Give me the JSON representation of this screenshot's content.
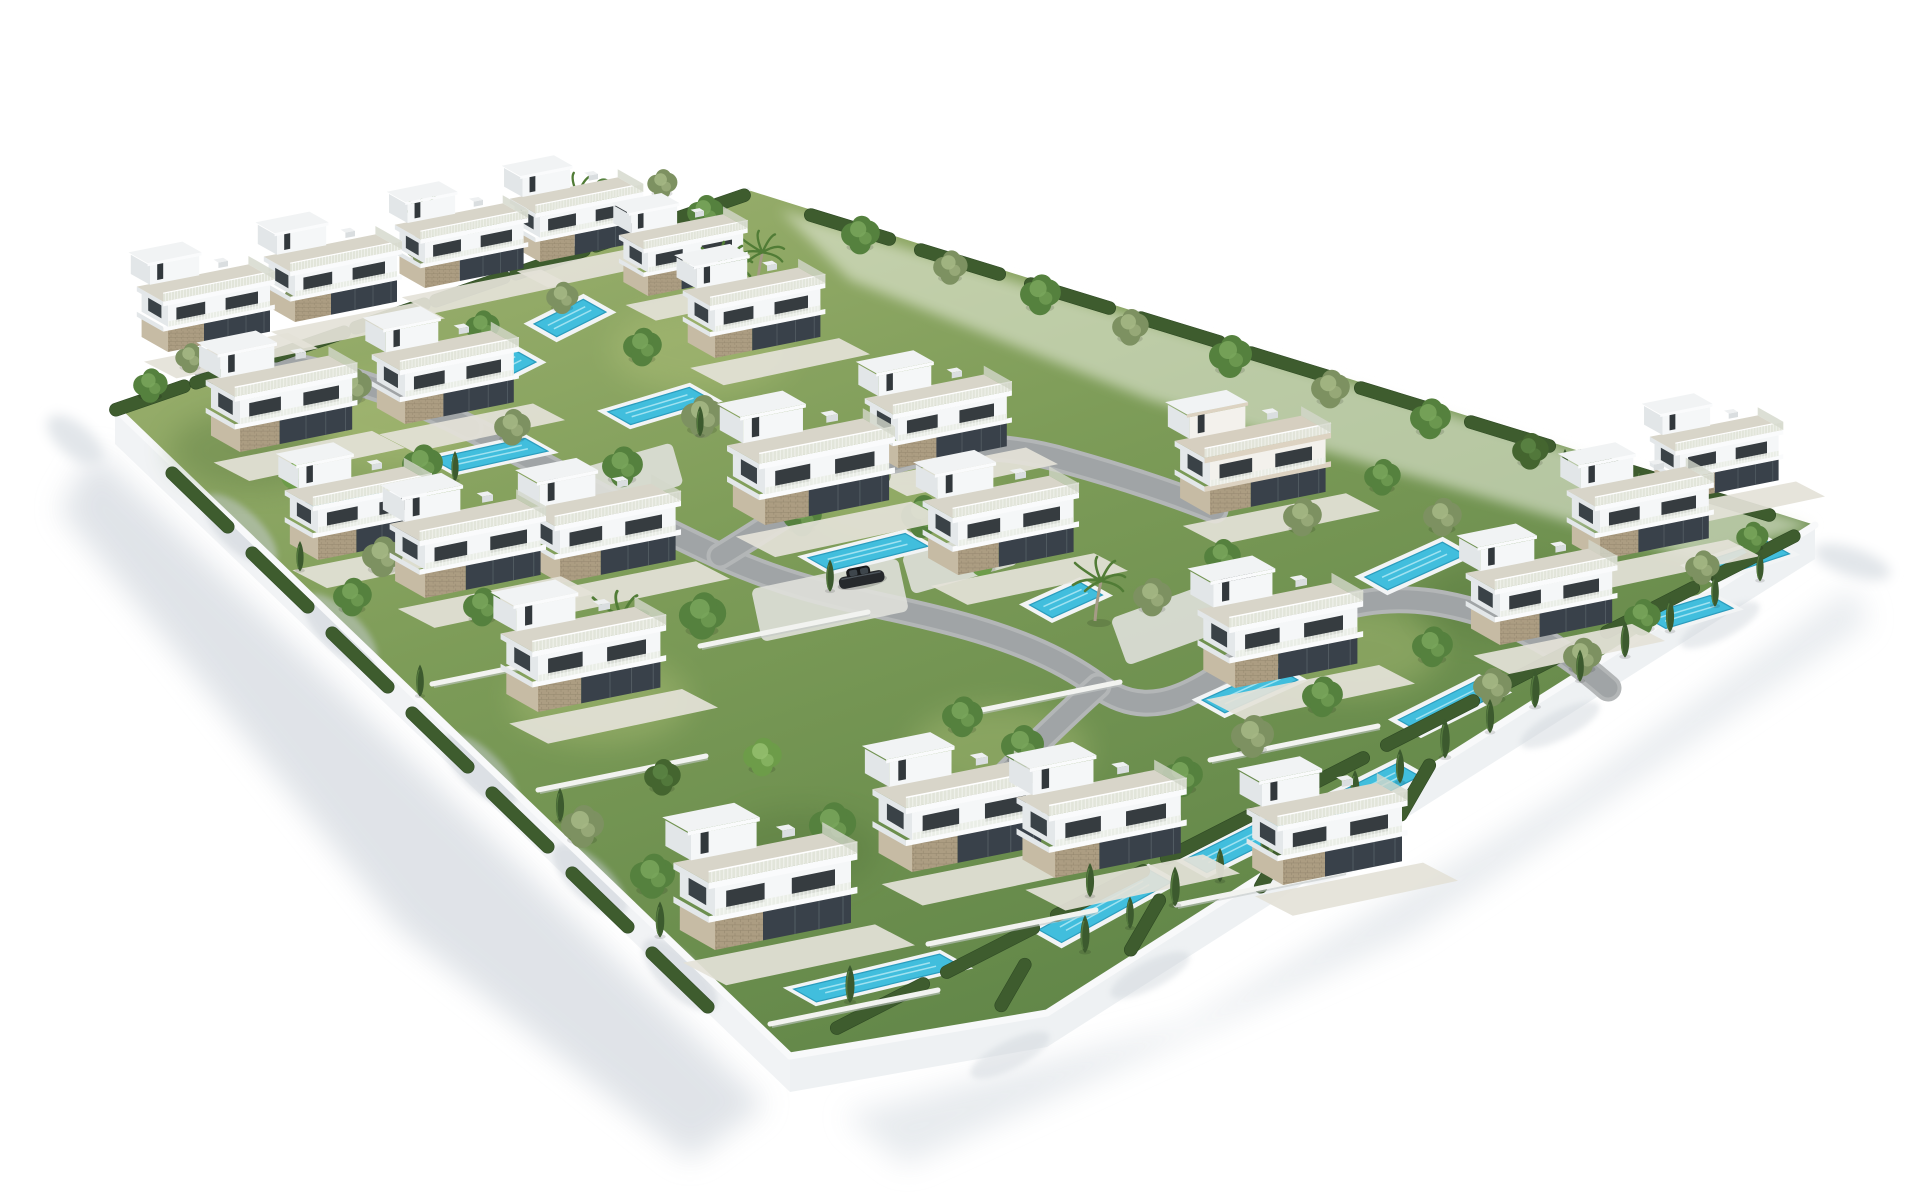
{
  "scene": {
    "subject": "aerial 3d render of a gated residential development of white modern villas with rooftop terraces, private turquoise pools, gardens, trees and winding gray roads inside a white perimeter wall on a plain white background",
    "background_color": "#ffffff",
    "palette": {
      "villa_white": "#f5f7f8",
      "villa_shade": "#e4e8ea",
      "slab_white": "#fafbfc",
      "glass_dark": "#39414a",
      "stone_tan": "#ac9d82",
      "deck_gray": "#d8d5c9",
      "grass_light": "#a3b573",
      "grass_mid": "#7d9c58",
      "grass_dark": "#5c8245",
      "hedge_green": "#3e5c2e",
      "tree_green": "#55813e",
      "pool_cyan": "#41bedd",
      "pool_deep": "#2b9cbd",
      "road_gray": "#9fa3a4",
      "wall_white": "#f1f3f5",
      "shadow_gray": "#dde1e6",
      "car_dark": "#26292c"
    },
    "counts": {
      "villas": 24,
      "swimming_pools": 16,
      "cars": 2,
      "palm_trees": 6,
      "round_trees": 64,
      "cypress_trees": 32
    },
    "walls": {
      "plot": "115,408 748,190 1815,525 1420,775 1047,1013 790,1056",
      "left_face": "115,408 790,1056 790,1092 115,444",
      "bottom_face": "790,1056 1047,1013 1420,775 1815,525 1815,559 1420,809 1047,1047 790,1092",
      "cap_left": "115,408 790,1056",
      "cap_bottom": "790,1056 1047,1013 1420,775 1815,525",
      "cap_top": "115,408 748,190",
      "pale_topright": "780,210 1815,525 1700,560 1150,400 850,280"
    },
    "ground_shadows": {
      "left": "95,450 765,1105 690,1160 400,930 215,700 60,510",
      "bottom_right": "845,1115 1185,1025 1565,795 1852,588 1868,622 1410,935 905,1165",
      "blobs": [
        {
          "x": 75,
          "y": 440,
          "rx": 34,
          "ry": 16,
          "a": 40
        },
        {
          "x": 1852,
          "y": 562,
          "rx": 40,
          "ry": 14,
          "a": 18
        }
      ],
      "wall_blobs_left": [
        [
          240,
          530
        ],
        [
          340,
          630
        ],
        [
          480,
          770
        ],
        [
          590,
          880
        ],
        [
          680,
          975
        ]
      ],
      "wall_blobs_bottom": [
        [
          1010,
          1055
        ],
        [
          1150,
          975
        ],
        [
          1340,
          860
        ],
        [
          1560,
          725
        ],
        [
          1720,
          625
        ]
      ]
    },
    "grass_patches": {
      "light": [
        [
          400,
          420
        ],
        [
          700,
          350
        ],
        [
          600,
          700
        ],
        [
          1000,
          750
        ],
        [
          1350,
          650
        ],
        [
          900,
          500
        ]
      ],
      "dark": [
        [
          250,
          450
        ],
        [
          800,
          850
        ],
        [
          1500,
          600
        ]
      ]
    },
    "roads": [
      "M 470,428 C 560,472 640,520 720,556 S 860,600 930,617 C 1010,636 1060,658 1098,686 C 1140,716 1180,706 1238,662 C 1300,615 1360,592 1432,602 C 1505,613 1560,646 1608,688",
      "M 720,556 C 780,520 830,482 890,462 C 950,442 1010,444 1070,462 C 1120,476 1170,492 1215,510",
      "M 470,428 C 420,402 370,384 320,372 C 280,362 240,360 205,366",
      "M 1098,686 C 1060,720 1020,760 980,800"
    ],
    "pads": [
      {
        "x": 830,
        "y": 600,
        "w": 150,
        "h": 54,
        "a": -12
      },
      {
        "x": 1180,
        "y": 620,
        "w": 130,
        "h": 50,
        "a": -20
      },
      {
        "x": 620,
        "y": 480,
        "w": 120,
        "h": 44,
        "a": -16
      },
      {
        "x": 960,
        "y": 560,
        "w": 110,
        "h": 40,
        "a": -16
      }
    ],
    "pools": [
      {
        "x": 346,
        "y": 500,
        "l": 60,
        "k": -0.3
      },
      {
        "x": 490,
        "y": 455,
        "l": 95,
        "k": -0.22
      },
      {
        "x": 500,
        "y": 368,
        "l": 55,
        "k": -0.5
      },
      {
        "x": 570,
        "y": 318,
        "l": 55,
        "k": -0.5
      },
      {
        "x": 660,
        "y": 406,
        "l": 85,
        "k": -0.3
      },
      {
        "x": 868,
        "y": 552,
        "l": 100,
        "k": -0.25
      },
      {
        "x": 1066,
        "y": 600,
        "l": 55,
        "k": -0.45
      },
      {
        "x": 1415,
        "y": 566,
        "l": 85,
        "k": -0.45
      },
      {
        "x": 1740,
        "y": 560,
        "l": 80,
        "k": -0.33
      },
      {
        "x": 1250,
        "y": 690,
        "l": 80,
        "k": -0.45
      },
      {
        "x": 1450,
        "y": 706,
        "l": 90,
        "k": -0.5
      },
      {
        "x": 1688,
        "y": 612,
        "l": 70,
        "k": -0.3
      },
      {
        "x": 878,
        "y": 978,
        "l": 150,
        "k": -0.24
      },
      {
        "x": 1105,
        "y": 906,
        "l": 125,
        "k": -0.55
      },
      {
        "x": 1238,
        "y": 845,
        "l": 95,
        "k": -0.5
      },
      {
        "x": 1368,
        "y": 790,
        "l": 90,
        "k": -0.5
      }
    ],
    "hedges": [
      {
        "x": 150,
        "y": 398,
        "l": 85,
        "a": -19
      },
      {
        "x": 230,
        "y": 371,
        "l": 85,
        "a": -19
      },
      {
        "x": 310,
        "y": 344,
        "l": 85,
        "a": -19
      },
      {
        "x": 390,
        "y": 316,
        "l": 85,
        "a": -19
      },
      {
        "x": 470,
        "y": 289,
        "l": 85,
        "a": -19
      },
      {
        "x": 550,
        "y": 262,
        "l": 85,
        "a": -19
      },
      {
        "x": 630,
        "y": 234,
        "l": 85,
        "a": -19
      },
      {
        "x": 710,
        "y": 207,
        "l": 85,
        "a": -19
      },
      {
        "x": 880,
        "y": 1006,
        "l": 110,
        "a": -27
      },
      {
        "x": 990,
        "y": 950,
        "l": 110,
        "a": -27
      },
      {
        "x": 1100,
        "y": 893,
        "l": 110,
        "a": -27
      },
      {
        "x": 1210,
        "y": 836,
        "l": 110,
        "a": -27
      },
      {
        "x": 1320,
        "y": 780,
        "l": 110,
        "a": -27
      },
      {
        "x": 1430,
        "y": 723,
        "l": 110,
        "a": -27
      },
      {
        "x": 1540,
        "y": 666,
        "l": 110,
        "a": -27
      },
      {
        "x": 1650,
        "y": 610,
        "l": 110,
        "a": -27
      },
      {
        "x": 1755,
        "y": 556,
        "l": 100,
        "a": -27
      },
      {
        "x": 200,
        "y": 500,
        "l": 90,
        "a": 44
      },
      {
        "x": 280,
        "y": 580,
        "l": 90,
        "a": 44
      },
      {
        "x": 360,
        "y": 660,
        "l": 90,
        "a": 44
      },
      {
        "x": 440,
        "y": 740,
        "l": 90,
        "a": 44
      },
      {
        "x": 520,
        "y": 820,
        "l": 90,
        "a": 44
      },
      {
        "x": 600,
        "y": 900,
        "l": 90,
        "a": 44
      },
      {
        "x": 680,
        "y": 980,
        "l": 90,
        "a": 44
      },
      {
        "x": 850,
        "y": 227,
        "l": 95,
        "a": 17
      },
      {
        "x": 960,
        "y": 262,
        "l": 95,
        "a": 17
      },
      {
        "x": 1070,
        "y": 296,
        "l": 95,
        "a": 17
      },
      {
        "x": 1180,
        "y": 330,
        "l": 95,
        "a": 17
      },
      {
        "x": 1290,
        "y": 365,
        "l": 95,
        "a": 17
      },
      {
        "x": 1400,
        "y": 400,
        "l": 95,
        "a": 17
      },
      {
        "x": 1510,
        "y": 434,
        "l": 95,
        "a": 17
      },
      {
        "x": 1620,
        "y": 468,
        "l": 95,
        "a": 17
      },
      {
        "x": 1730,
        "y": 503,
        "l": 95,
        "a": 17
      },
      {
        "x": 1145,
        "y": 925,
        "l": 70,
        "a": -60
      },
      {
        "x": 1275,
        "y": 862,
        "l": 70,
        "a": -60
      },
      {
        "x": 1013,
        "y": 985,
        "l": 60,
        "a": -60
      },
      {
        "x": 1415,
        "y": 790,
        "l": 70,
        "a": -60
      }
    ],
    "low_walls": [
      [
        700,
        646,
        868,
        612
      ],
      [
        432,
        684,
        600,
        650
      ],
      [
        952,
        716,
        1120,
        682
      ],
      [
        1210,
        760,
        1378,
        726
      ],
      [
        538,
        790,
        706,
        756
      ],
      [
        770,
        1024,
        938,
        990
      ],
      [
        928,
        944,
        1096,
        910
      ],
      [
        1176,
        905,
        1344,
        871
      ]
    ],
    "villas": [
      {
        "x": 168,
        "y": 352,
        "s": 0.6,
        "v": "a"
      },
      {
        "x": 295,
        "y": 322,
        "s": 0.6,
        "v": "a"
      },
      {
        "x": 425,
        "y": 288,
        "s": 0.58,
        "v": "a"
      },
      {
        "x": 540,
        "y": 262,
        "s": 0.58,
        "v": "a"
      },
      {
        "x": 648,
        "y": 296,
        "s": 0.56,
        "v": "a"
      },
      {
        "x": 715,
        "y": 358,
        "s": 0.62,
        "v": "a"
      },
      {
        "x": 240,
        "y": 452,
        "s": 0.66,
        "v": "a"
      },
      {
        "x": 405,
        "y": 424,
        "s": 0.64,
        "v": "a"
      },
      {
        "x": 898,
        "y": 468,
        "s": 0.64,
        "v": "a"
      },
      {
        "x": 958,
        "y": 575,
        "s": 0.68,
        "v": "a"
      },
      {
        "x": 765,
        "y": 525,
        "s": 0.73,
        "v": "a"
      },
      {
        "x": 425,
        "y": 598,
        "s": 0.68,
        "v": "a"
      },
      {
        "x": 560,
        "y": 583,
        "s": 0.68,
        "v": "a"
      },
      {
        "x": 538,
        "y": 712,
        "s": 0.72,
        "v": "a"
      },
      {
        "x": 1210,
        "y": 515,
        "s": 0.68,
        "v": "b"
      },
      {
        "x": 1235,
        "y": 688,
        "s": 0.72,
        "v": "a"
      },
      {
        "x": 1500,
        "y": 645,
        "s": 0.66,
        "v": "a"
      },
      {
        "x": 1600,
        "y": 560,
        "s": 0.64,
        "v": "a"
      },
      {
        "x": 1680,
        "y": 500,
        "s": 0.58,
        "v": "a"
      },
      {
        "x": 715,
        "y": 950,
        "s": 0.8,
        "v": "a"
      },
      {
        "x": 912,
        "y": 872,
        "s": 0.76,
        "v": "a"
      },
      {
        "x": 1055,
        "y": 878,
        "s": 0.74,
        "v": "a"
      },
      {
        "x": 1283,
        "y": 885,
        "s": 0.7,
        "v": "a"
      },
      {
        "x": 318,
        "y": 560,
        "s": 0.64,
        "v": "a"
      }
    ],
    "trees": [
      {
        "x": 150,
        "y": 390,
        "s": 0.8,
        "t": "g"
      },
      {
        "x": 190,
        "y": 362,
        "s": 0.7,
        "t": "o"
      },
      {
        "x": 235,
        "y": 332,
        "s": 0.9,
        "t": "g"
      },
      {
        "x": 300,
        "y": 302,
        "s": 0.75,
        "t": "o"
      },
      {
        "x": 362,
        "y": 282,
        "s": 0.9,
        "t": "d"
      },
      {
        "x": 422,
        "y": 252,
        "s": 0.8,
        "t": "o"
      },
      {
        "x": 482,
        "y": 232,
        "s": 0.85,
        "t": "g"
      },
      {
        "x": 542,
        "y": 212,
        "s": 0.7,
        "t": "o"
      },
      {
        "x": 602,
        "y": 200,
        "s": 0.8,
        "t": "g"
      },
      {
        "x": 662,
        "y": 188,
        "s": 0.7,
        "t": "o"
      },
      {
        "x": 705,
        "y": 218,
        "s": 0.85,
        "t": "g"
      },
      {
        "x": 860,
        "y": 240,
        "s": 0.9,
        "t": "g"
      },
      {
        "x": 950,
        "y": 272,
        "s": 0.8,
        "t": "o"
      },
      {
        "x": 1040,
        "y": 300,
        "s": 0.95,
        "t": "g"
      },
      {
        "x": 1130,
        "y": 332,
        "s": 0.85,
        "t": "o"
      },
      {
        "x": 1230,
        "y": 362,
        "s": 1.0,
        "t": "g"
      },
      {
        "x": 1330,
        "y": 394,
        "s": 0.9,
        "t": "o"
      },
      {
        "x": 1430,
        "y": 424,
        "s": 0.95,
        "t": "g"
      },
      {
        "x": 1530,
        "y": 456,
        "s": 0.85,
        "t": "d"
      },
      {
        "x": 1660,
        "y": 498,
        "s": 0.9,
        "t": "g"
      },
      {
        "x": 255,
        "y": 420,
        "s": 1.0,
        "t": "g"
      },
      {
        "x": 352,
        "y": 392,
        "s": 0.9,
        "t": "o"
      },
      {
        "x": 302,
        "y": 482,
        "s": 1.0,
        "t": "b"
      },
      {
        "x": 422,
        "y": 470,
        "s": 0.95,
        "t": "g"
      },
      {
        "x": 512,
        "y": 432,
        "s": 0.85,
        "t": "o"
      },
      {
        "x": 482,
        "y": 332,
        "s": 0.8,
        "t": "g"
      },
      {
        "x": 562,
        "y": 302,
        "s": 0.75,
        "t": "o"
      },
      {
        "x": 642,
        "y": 352,
        "s": 0.9,
        "t": "g"
      },
      {
        "x": 702,
        "y": 422,
        "s": 1.0,
        "t": "o"
      },
      {
        "x": 622,
        "y": 472,
        "s": 0.95,
        "t": "g"
      },
      {
        "x": 702,
        "y": 622,
        "s": 1.1,
        "t": "g"
      },
      {
        "x": 562,
        "y": 642,
        "s": 1.0,
        "t": "o"
      },
      {
        "x": 482,
        "y": 612,
        "s": 0.9,
        "t": "g"
      },
      {
        "x": 382,
        "y": 562,
        "s": 0.95,
        "t": "o"
      },
      {
        "x": 802,
        "y": 522,
        "s": 0.9,
        "t": "g"
      },
      {
        "x": 872,
        "y": 482,
        "s": 0.85,
        "t": "o"
      },
      {
        "x": 922,
        "y": 522,
        "s": 1.0,
        "t": "g"
      },
      {
        "x": 982,
        "y": 562,
        "s": 0.9,
        "t": "b"
      },
      {
        "x": 352,
        "y": 602,
        "s": 0.9,
        "t": "g"
      },
      {
        "x": 582,
        "y": 832,
        "s": 1.0,
        "t": "o"
      },
      {
        "x": 652,
        "y": 882,
        "s": 1.05,
        "t": "g"
      },
      {
        "x": 722,
        "y": 902,
        "s": 0.9,
        "t": "o"
      },
      {
        "x": 832,
        "y": 832,
        "s": 1.1,
        "t": "g"
      },
      {
        "x": 902,
        "y": 782,
        "s": 1.0,
        "t": "o"
      },
      {
        "x": 962,
        "y": 722,
        "s": 0.95,
        "t": "g"
      },
      {
        "x": 762,
        "y": 762,
        "s": 0.9,
        "t": "b"
      },
      {
        "x": 662,
        "y": 782,
        "s": 0.85,
        "t": "d"
      },
      {
        "x": 1022,
        "y": 752,
        "s": 1.0,
        "t": "g"
      },
      {
        "x": 1102,
        "y": 822,
        "s": 1.05,
        "t": "o"
      },
      {
        "x": 1182,
        "y": 782,
        "s": 0.95,
        "t": "g"
      },
      {
        "x": 1252,
        "y": 742,
        "s": 1.0,
        "t": "o"
      },
      {
        "x": 1322,
        "y": 702,
        "s": 0.95,
        "t": "g"
      },
      {
        "x": 1152,
        "y": 602,
        "s": 0.9,
        "t": "o"
      },
      {
        "x": 1222,
        "y": 562,
        "s": 0.85,
        "t": "g"
      },
      {
        "x": 1302,
        "y": 522,
        "s": 0.9,
        "t": "o"
      },
      {
        "x": 1382,
        "y": 482,
        "s": 0.85,
        "t": "g"
      },
      {
        "x": 1442,
        "y": 522,
        "s": 0.9,
        "t": "o"
      },
      {
        "x": 1502,
        "y": 562,
        "s": 0.95,
        "t": "g"
      },
      {
        "x": 1582,
        "y": 662,
        "s": 0.9,
        "t": "o"
      },
      {
        "x": 1432,
        "y": 652,
        "s": 0.95,
        "t": "g"
      },
      {
        "x": 1492,
        "y": 692,
        "s": 0.9,
        "t": "o"
      },
      {
        "x": 1642,
        "y": 622,
        "s": 0.85,
        "t": "g"
      },
      {
        "x": 1702,
        "y": 572,
        "s": 0.8,
        "t": "o"
      },
      {
        "x": 1752,
        "y": 542,
        "s": 0.75,
        "t": "g"
      }
    ],
    "cypresses": [
      {
        "x": 1085,
        "y": 945,
        "s": 1.0
      },
      {
        "x": 1130,
        "y": 922,
        "s": 0.85
      },
      {
        "x": 1175,
        "y": 898,
        "s": 1.05
      },
      {
        "x": 1220,
        "y": 875,
        "s": 0.9
      },
      {
        "x": 1265,
        "y": 850,
        "s": 1.0
      },
      {
        "x": 1310,
        "y": 826,
        "s": 0.85
      },
      {
        "x": 1355,
        "y": 800,
        "s": 1.0
      },
      {
        "x": 1400,
        "y": 776,
        "s": 0.9
      },
      {
        "x": 1445,
        "y": 750,
        "s": 1.05
      },
      {
        "x": 1490,
        "y": 726,
        "s": 0.9
      },
      {
        "x": 1535,
        "y": 700,
        "s": 1.0
      },
      {
        "x": 1580,
        "y": 675,
        "s": 0.85
      },
      {
        "x": 1625,
        "y": 650,
        "s": 0.95
      },
      {
        "x": 1670,
        "y": 625,
        "s": 0.9
      },
      {
        "x": 1715,
        "y": 600,
        "s": 0.85
      },
      {
        "x": 1760,
        "y": 575,
        "s": 0.8
      },
      {
        "x": 1565,
        "y": 470,
        "s": 0.7
      },
      {
        "x": 1590,
        "y": 477,
        "s": 0.75
      },
      {
        "x": 1615,
        "y": 484,
        "s": 0.7
      },
      {
        "x": 1640,
        "y": 491,
        "s": 0.75
      },
      {
        "x": 1665,
        "y": 498,
        "s": 0.7
      },
      {
        "x": 1690,
        "y": 505,
        "s": 0.75
      },
      {
        "x": 455,
        "y": 475,
        "s": 0.8
      },
      {
        "x": 340,
        "y": 515,
        "s": 0.75
      },
      {
        "x": 830,
        "y": 585,
        "s": 0.85
      },
      {
        "x": 850,
        "y": 995,
        "s": 1.0
      },
      {
        "x": 1090,
        "y": 890,
        "s": 0.9
      },
      {
        "x": 700,
        "y": 430,
        "s": 0.8
      },
      {
        "x": 300,
        "y": 565,
        "s": 0.8
      },
      {
        "x": 420,
        "y": 690,
        "s": 0.85
      },
      {
        "x": 560,
        "y": 815,
        "s": 0.9
      },
      {
        "x": 660,
        "y": 930,
        "s": 0.95
      }
    ],
    "palms": [
      {
        "x": 420,
        "y": 242,
        "s": 0.9
      },
      {
        "x": 572,
        "y": 225,
        "s": 0.9
      },
      {
        "x": 722,
        "y": 300,
        "s": 1.0
      },
      {
        "x": 757,
        "y": 283,
        "s": 0.9
      },
      {
        "x": 615,
        "y": 655,
        "s": 1.1
      },
      {
        "x": 1095,
        "y": 615,
        "s": 1.0
      }
    ],
    "cars": [
      {
        "x": 838,
        "y": 578,
        "a": -11
      },
      {
        "x": 1212,
        "y": 592,
        "a": -29
      }
    ]
  }
}
